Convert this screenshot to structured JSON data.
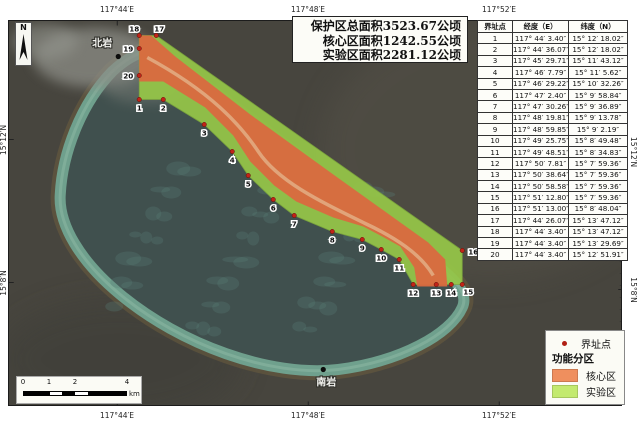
{
  "stats_box": {
    "lines": [
      "保护区总面积3523.67公顷",
      "核心区面积1242.55公顷",
      "实验区面积2281.12公顷"
    ]
  },
  "table": {
    "headers": [
      "界址点",
      "经度（E）",
      "纬度（N）"
    ],
    "rows": [
      [
        "1",
        "117° 44′ 3.40″",
        "15° 12′ 18.02″"
      ],
      [
        "2",
        "117° 44′ 36.07″",
        "15° 12′ 18.02″"
      ],
      [
        "3",
        "117° 45′ 29.71″",
        "15° 11′ 43.12″"
      ],
      [
        "4",
        "117° 46′ 7.79″",
        "15° 11′ 5.62″"
      ],
      [
        "5",
        "117° 46′ 29.22″",
        "15° 10′ 32.26″"
      ],
      [
        "6",
        "117° 47′ 2.40″",
        "15° 9′ 58.84″"
      ],
      [
        "7",
        "117° 47′ 30.26″",
        "15° 9′ 36.89″"
      ],
      [
        "8",
        "117° 48′ 19.81″",
        "15° 9′ 13.78″"
      ],
      [
        "9",
        "117° 48′ 59.85″",
        "15° 9′ 2.19″"
      ],
      [
        "10",
        "117° 49′ 25.75″",
        "15° 8′ 49.48″"
      ],
      [
        "11",
        "117° 49′ 48.51″",
        "15° 8′ 34.83″"
      ],
      [
        "12",
        "117° 50′ 7.81″",
        "15° 7′ 59.36″"
      ],
      [
        "13",
        "117° 50′ 38.64″",
        "15° 7′ 59.36″"
      ],
      [
        "14",
        "117° 50′ 58.58″",
        "15° 7′ 59.36″"
      ],
      [
        "15",
        "117° 51′ 12.80″",
        "15° 7′ 59.36″"
      ],
      [
        "16",
        "117° 51′ 13.00″",
        "15° 8′ 48.04″"
      ],
      [
        "17",
        "117° 44′ 26.07″",
        "15° 13′ 47.12″"
      ],
      [
        "18",
        "117° 44′ 3.40″",
        "15° 13′ 47.12″"
      ],
      [
        "19",
        "117° 44′ 3.40″",
        "15° 13′ 29.69″"
      ],
      [
        "20",
        "117° 44′ 3.40″",
        "15° 12′ 51.91″"
      ]
    ]
  },
  "legend": {
    "point_label": "界址点",
    "point_color": "#b01f14",
    "group_title": "功能分区",
    "items": [
      {
        "label": "核心区",
        "color": "#EF8F5E"
      },
      {
        "label": "实验区",
        "color": "#C3EA6F"
      }
    ]
  },
  "scalebar": {
    "ticks": [
      {
        "label": "0",
        "x": 6
      },
      {
        "label": "1",
        "x": 32
      },
      {
        "label": "2",
        "x": 58
      },
      {
        "label": "4",
        "x": 110
      }
    ],
    "segments": [
      {
        "w": 26,
        "c": "#000"
      },
      {
        "w": 13,
        "c": "#fff"
      },
      {
        "w": 13,
        "c": "#000"
      },
      {
        "w": 13,
        "c": "#fff"
      },
      {
        "w": 39,
        "c": "#000"
      }
    ],
    "unit": "km"
  },
  "north_arrow": {
    "label": "N"
  },
  "axis": {
    "top": [
      {
        "label": "117°44′E",
        "x": 117
      },
      {
        "label": "117°48′E",
        "x": 308
      },
      {
        "label": "117°52′E",
        "x": 499
      }
    ],
    "bottom": [
      {
        "label": "117°44′E",
        "x": 117
      },
      {
        "label": "117°48′E",
        "x": 308
      },
      {
        "label": "117°52′E",
        "x": 499
      }
    ],
    "left": [
      {
        "label": "15°12′N",
        "y": 140
      },
      {
        "label": "15°8′N",
        "y": 283
      }
    ],
    "right": [
      {
        "label": "15°12′N",
        "y": 152
      },
      {
        "label": "15°8′N",
        "y": 290
      }
    ]
  },
  "map": {
    "zone_colors": {
      "core": "#D96A3F",
      "experimental": "#96C748"
    },
    "boundary_point_color": "#c22418",
    "rock_labels": [
      {
        "text": "北岩",
        "x": 102,
        "y": 47,
        "dot": [
          118,
          57
        ]
      },
      {
        "text": "南岩",
        "x": 326,
        "y": 386,
        "dot": [
          323,
          370
        ]
      }
    ],
    "boundary_points": [
      {
        "id": "1",
        "x": 139,
        "y": 100
      },
      {
        "id": "2",
        "x": 163,
        "y": 100
      },
      {
        "id": "3",
        "x": 204,
        "y": 125
      },
      {
        "id": "4",
        "x": 232,
        "y": 152
      },
      {
        "id": "5",
        "x": 248,
        "y": 176
      },
      {
        "id": "6",
        "x": 273,
        "y": 200
      },
      {
        "id": "7",
        "x": 294,
        "y": 216
      },
      {
        "id": "8",
        "x": 332,
        "y": 232
      },
      {
        "id": "9",
        "x": 362,
        "y": 240
      },
      {
        "id": "10",
        "x": 381,
        "y": 250
      },
      {
        "id": "11",
        "x": 399,
        "y": 260
      },
      {
        "id": "12",
        "x": 413,
        "y": 285
      },
      {
        "id": "13",
        "x": 436,
        "y": 285
      },
      {
        "id": "14",
        "x": 451,
        "y": 285
      },
      {
        "id": "15",
        "x": 462,
        "y": 285
      },
      {
        "id": "16",
        "x": 462,
        "y": 251
      },
      {
        "id": "17",
        "x": 156,
        "y": 36
      },
      {
        "id": "18",
        "x": 139,
        "y": 36
      },
      {
        "id": "19",
        "x": 139,
        "y": 49
      },
      {
        "id": "20",
        "x": 139,
        "y": 76
      }
    ],
    "core_polygon": [
      [
        139,
        36
      ],
      [
        151,
        36
      ],
      [
        175,
        57
      ],
      [
        250,
        115
      ],
      [
        340,
        180
      ],
      [
        428,
        243
      ],
      [
        445,
        260
      ],
      [
        447,
        287
      ],
      [
        417,
        287
      ],
      [
        414,
        268
      ],
      [
        400,
        247
      ],
      [
        382,
        237
      ],
      [
        363,
        227
      ],
      [
        333,
        218
      ],
      [
        296,
        202
      ],
      [
        274,
        186
      ],
      [
        250,
        162
      ],
      [
        233,
        136
      ],
      [
        205,
        108
      ],
      [
        163,
        82
      ],
      [
        139,
        82
      ]
    ]
  }
}
